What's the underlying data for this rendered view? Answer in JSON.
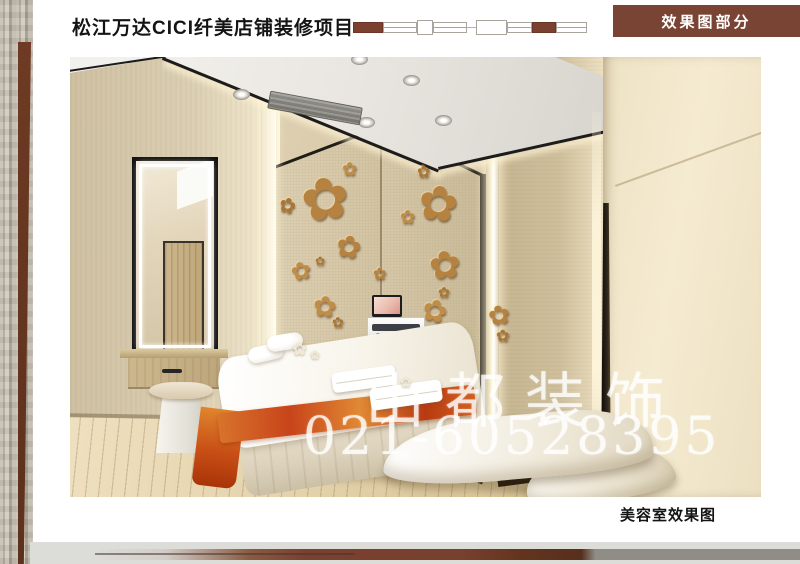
{
  "header": {
    "title": "松江万达CICI纤美店铺装修项目",
    "section_label": "效果图部分"
  },
  "footer": {
    "caption": "美容室效果图"
  },
  "watermark": {
    "company": "山都装饰",
    "phone": "021-60528395"
  },
  "colors": {
    "accent_brown": "#7a4434",
    "ornament_brown": "#7a4030",
    "bronze_flower": "#b5823f",
    "wall_beige": "#d6c8aa",
    "cream_panel": "#f0e4c8",
    "footer_bar_gray": "#dcdcd9"
  }
}
